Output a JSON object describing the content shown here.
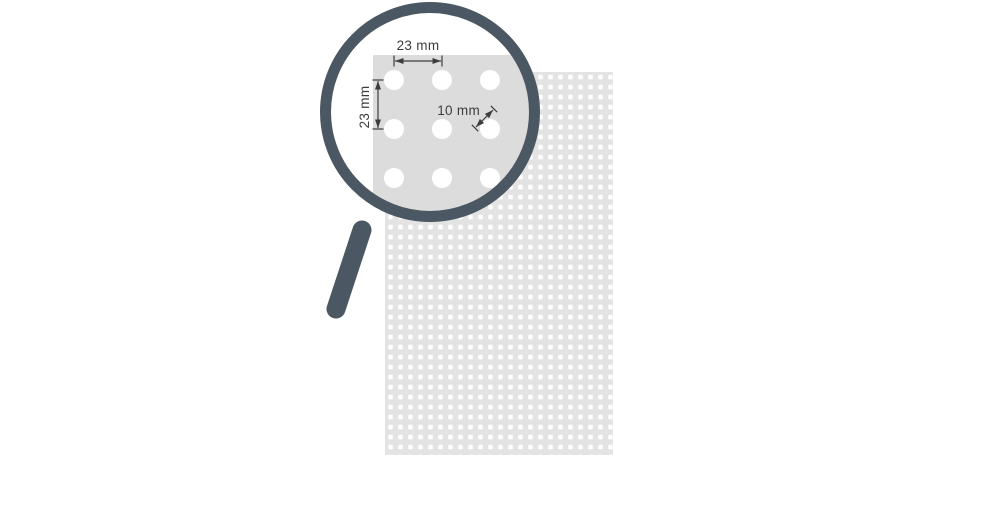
{
  "diagram": {
    "name": "perforated-sheet-hole-pattern",
    "description": "Magnifying glass zooming into a perforated sheet showing round hole pattern dimensions",
    "annotations": {
      "pitch_horizontal_label": "23 mm",
      "pitch_vertical_label": "23 mm",
      "hole_diameter_label": "10 mm"
    },
    "sheet_spec": {
      "hole_pitch_mm": 23,
      "hole_diameter_mm": 10,
      "pattern": "straight square grid",
      "rows_in_lens": 3,
      "cols_in_lens": 3
    },
    "colors": {
      "magnifier": "#4b5863",
      "sheet": "#e3e3e3",
      "lens_panel": "#dcdcdc",
      "perforation": "#ffffff",
      "glass": "#ffffff",
      "dimension": "#3d3d3d",
      "background": "#ffffff"
    }
  }
}
